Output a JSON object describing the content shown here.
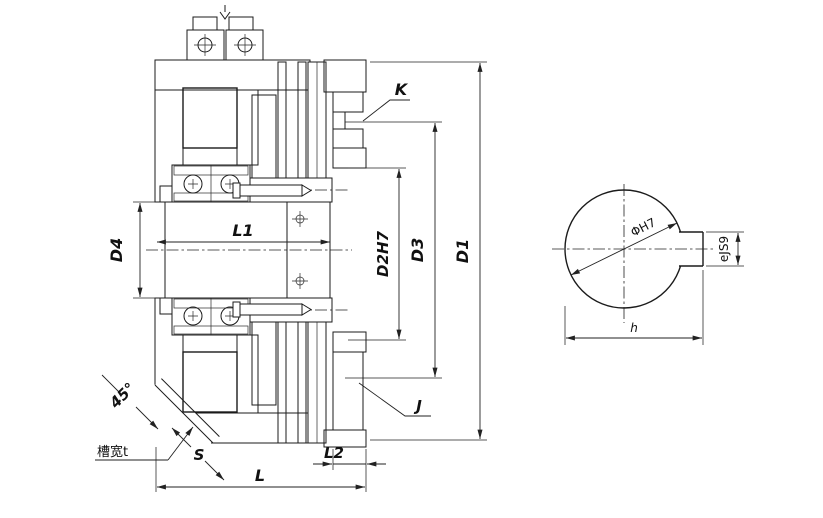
{
  "colors": {
    "line": "#1b1b1b",
    "dimension": "#222222",
    "background": "#ffffff"
  },
  "main_view": {
    "description": "electromagnetic-clutch-cross-section",
    "dim_labels": {
      "d4": "D4",
      "l1": "L1",
      "d2": "D2H7",
      "d3": "D3",
      "d1": "D1",
      "l": "L",
      "l2": "L2",
      "k": "K",
      "j": "J",
      "s": "S",
      "angle": "45°",
      "slot_width": "槽宽t"
    }
  },
  "detail_view": {
    "description": "shaft-bore-keyway-section",
    "dim_labels": {
      "bore_diameter": "ΦH7",
      "key_width": "eJS9",
      "key_depth": "h"
    }
  }
}
